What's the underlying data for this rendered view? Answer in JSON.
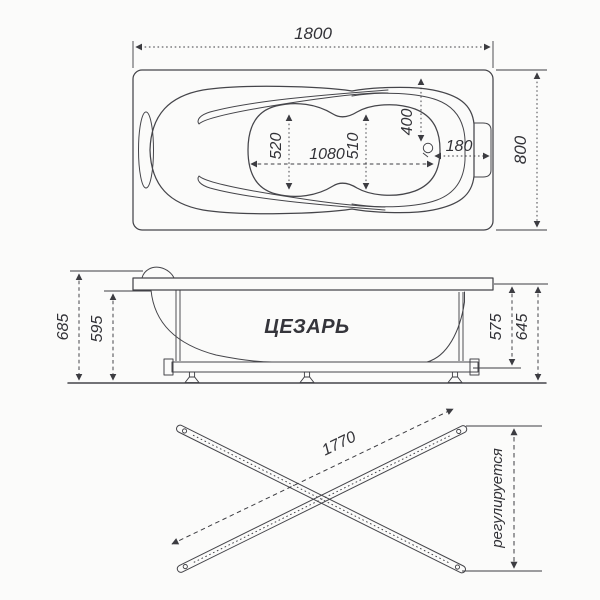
{
  "top_view": {
    "dims": {
      "overall_length": "1800",
      "overall_width": "800",
      "basin_width_left": "520",
      "basin_length": "1080",
      "basin_width_mid": "510",
      "drain_offset_long": "400",
      "drain_offset_end": "180"
    }
  },
  "side_view": {
    "product_label": "ЦЕЗАРЬ",
    "dims": {
      "total_height": "685",
      "rim_underside_height": "595",
      "shell_height": "575",
      "rim_top_height": "645"
    }
  },
  "base_view": {
    "dims": {
      "rail_length": "1770"
    },
    "adjustable_label": "регулируется"
  }
}
